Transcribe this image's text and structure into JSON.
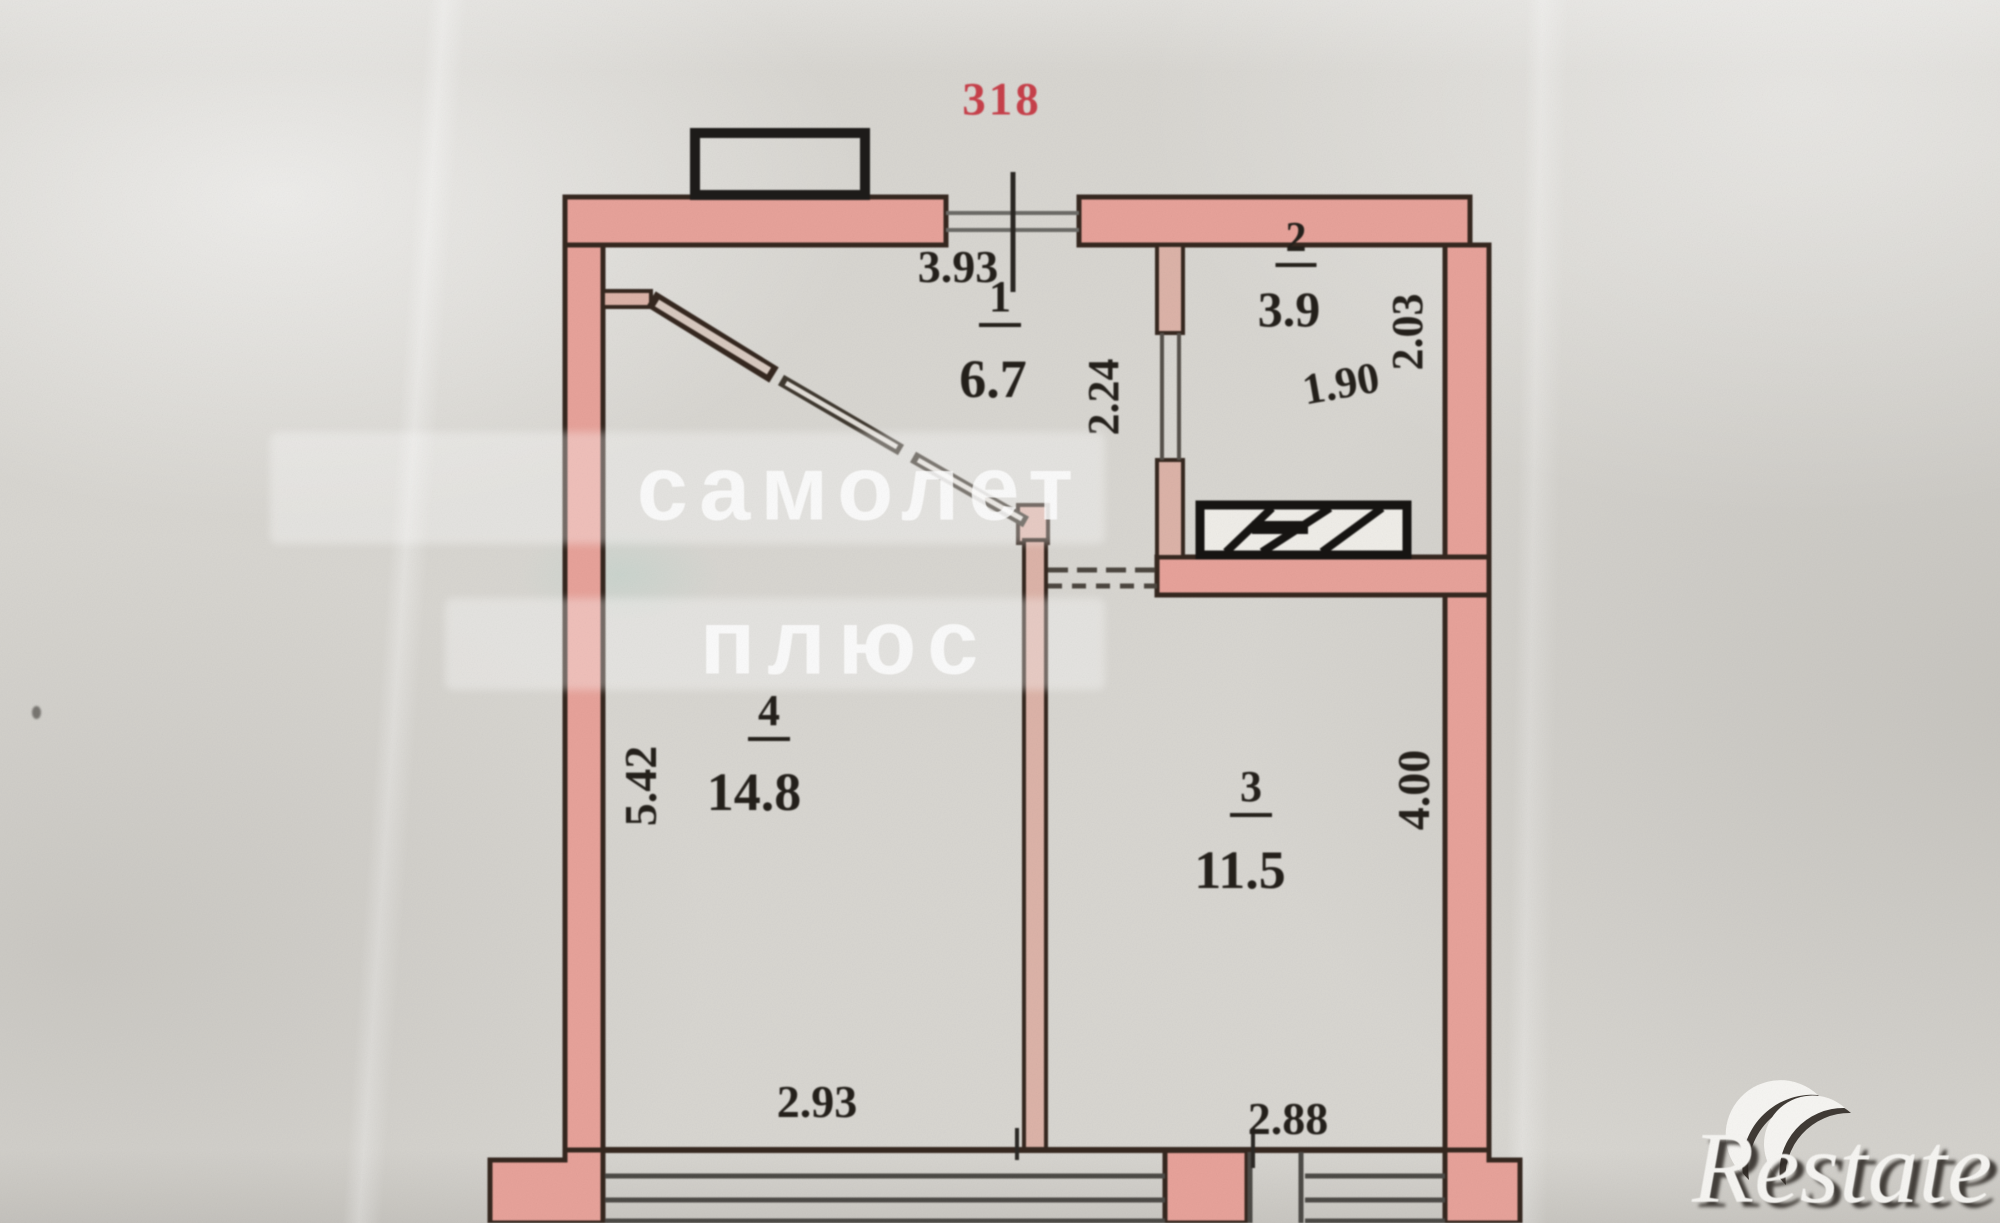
{
  "photo": {
    "apartment_number": "318",
    "rooms": [
      {
        "number": "1",
        "area": "6.7"
      },
      {
        "number": "2",
        "area": "3.9"
      },
      {
        "number": "3",
        "area": "11.5"
      },
      {
        "number": "4",
        "area": "14.8"
      }
    ],
    "dimensions": {
      "entrance_width": "3.93",
      "hallway_depth": "2.24",
      "room2_width": "1.90",
      "room2_depth": "2.03",
      "room3_width": "2.88",
      "room3_depth": "4.00",
      "room4_width": "2.93",
      "room4_depth": "5.42"
    },
    "watermarks": {
      "center_line1": "самолет",
      "center_line2": "плюс",
      "corner_brand": "Restate"
    },
    "colors": {
      "paper": "#d8d6d1",
      "wall_fill": "#e7a29a",
      "wall_outline": "#35271f",
      "detail_black": "#1c1a18",
      "dimension_text": "#24201b",
      "apartment_number_red": "#c7404a",
      "watermark_white": "#ffffff"
    }
  }
}
